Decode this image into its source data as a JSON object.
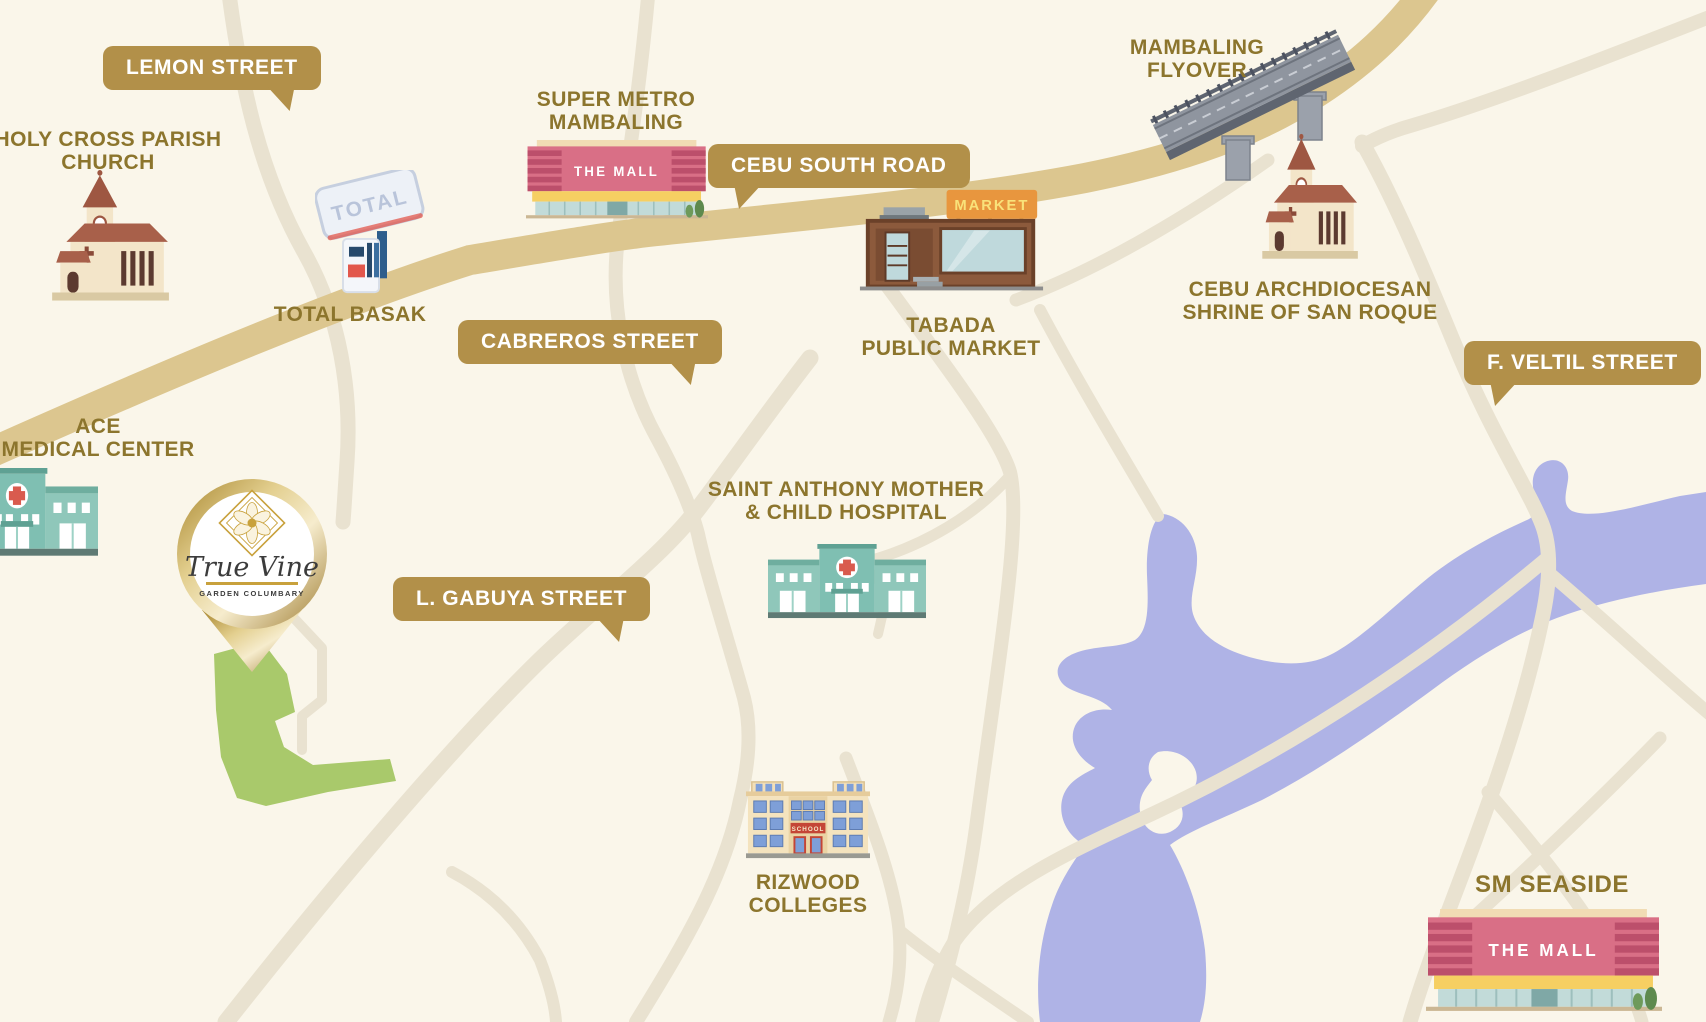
{
  "map": {
    "name": "True Vine Garden Columbary Vicinity Map",
    "street_tags": {
      "lemon": "LEMON STREET",
      "cebu_south": "CEBU SOUTH ROAD",
      "cabreros": "CABREROS STREET",
      "gabuya": "L. GABUYA STREET",
      "veltil": "F. VELTIL STREET"
    },
    "landmarks": {
      "holy_cross": {
        "line1": "HOLY CROSS PARISH",
        "line2": "CHURCH"
      },
      "total_basak": {
        "line1": "TOTAL BASAK"
      },
      "super_metro": {
        "line1": "SUPER METRO",
        "line2": "MAMBALING"
      },
      "mambaling_flyover": {
        "line1": "MAMBALING",
        "line2": "FLYOVER"
      },
      "tabada_market": {
        "line1": "TABADA",
        "line2": "PUBLIC MARKET"
      },
      "cebu_shrine": {
        "line1": "CEBU ARCHDIOCESAN",
        "line2": "SHRINE OF SAN ROQUE"
      },
      "ace_medical": {
        "line1": "ACE",
        "line2": "MEDICAL CENTER"
      },
      "saint_anthony": {
        "line1": "SAINT ANTHONY MOTHER",
        "line2": "& CHILD HOSPITAL"
      },
      "rizwood": {
        "line1": "RIZWOOD",
        "line2": "COLLEGES"
      },
      "sm_seaside": {
        "line1": "SM SEASIDE"
      }
    },
    "icon_texts": {
      "mall_sign": "THE MALL",
      "market_sign": "MARKET",
      "total_sign": "TOTAL",
      "school_sign": "SCHOOL"
    },
    "pin": {
      "brand": "True Vine",
      "subtitle": "GARDEN COLUMBARY"
    },
    "colors": {
      "background": "#FAF6EA",
      "road_primary": "#DCC68F",
      "road_secondary": "#E9E2D0",
      "water": "#AFB3E6",
      "property_green": "#A9C96B",
      "tag_gold": "#B29049",
      "label_text": "#8C752D",
      "pin_gold": "#C8A13C"
    }
  }
}
